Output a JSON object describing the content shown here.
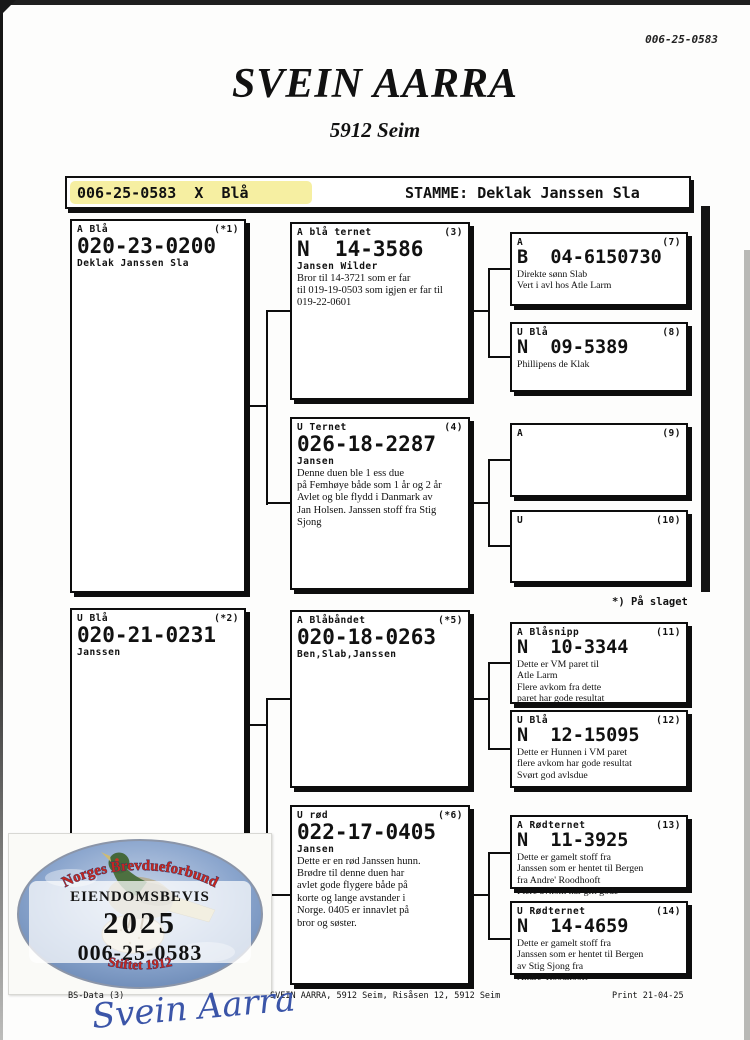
{
  "page": {
    "ref_number": "006-25-0583",
    "title": "SVEIN AARRA",
    "subtitle": "5912 Seim"
  },
  "id_bar": {
    "left_text": "006-25-0583  X  Blå",
    "stamme_text": "STAMME: Deklak Janssen Sla"
  },
  "footnote": "*) På slaget",
  "boxes": [
    {
      "color": "A Blå",
      "num": "(*1)",
      "ring": "020-23-0200",
      "strain": "Deklak Janssen Sla",
      "note": ""
    },
    {
      "color": "U Blå",
      "num": "(*2)",
      "ring": "020-21-0231",
      "strain": "Janssen",
      "note": ""
    },
    {
      "color": "A blå ternet",
      "num": "(3)",
      "ring": "N  14-3586",
      "strain": "Jansen Wilder",
      "note": "Bror til 14-3721 som er far\ntil 019-19-0503 som igjen er far til\n019-22-0601"
    },
    {
      "color": "U Ternet",
      "num": "(4)",
      "ring": "026-18-2287",
      "strain": "Jansen",
      "note": "Denne duen ble 1 ess due\npå Femhøye både som 1 år og 2 år\nAvlet og ble flydd i Danmark av\nJan Holsen. Janssen stoff fra Stig\nSjong"
    },
    {
      "color": "A Blåbåndet",
      "num": "(*5)",
      "ring": "020-18-0263",
      "strain": "Ben,Slab,Janssen",
      "note": ""
    },
    {
      "color": "U rød",
      "num": "(*6)",
      "ring": "022-17-0405",
      "strain": "Jansen",
      "note": "Dette er en rød Janssen hunn.\nBrødre til denne duen har\navlet gode flygere både på\nkorte og lange avstander i\nNorge. 0405 er innavlet på\nbror og søster."
    },
    {
      "color": "A",
      "num": "(7)",
      "ring": "B  04-6150730",
      "strain": "",
      "note": "Direkte sønn Slab\nVert i avl hos Atle Larm"
    },
    {
      "color": "U Blå",
      "num": "(8)",
      "ring": "N  09-5389",
      "strain": "",
      "note": "Phillipens de Klak"
    },
    {
      "color": "A",
      "num": "(9)",
      "ring": "",
      "strain": "",
      "note": ""
    },
    {
      "color": "U",
      "num": "(10)",
      "ring": "",
      "strain": "",
      "note": ""
    },
    {
      "color": "A Blåsnipp",
      "num": "(11)",
      "ring": "N  10-3344",
      "strain": "",
      "note": "Dette er VM paret til\nAtle Larm\nFlere avkom fra dette\nparet har gode resultat"
    },
    {
      "color": "U Blå",
      "num": "(12)",
      "ring": "N  12-15095",
      "strain": "",
      "note": "Dette er Hunnen i VM paret\nflere avkom har gode resultat\nSvørt god avlsdue"
    },
    {
      "color": "A Rødternet",
      "num": "(13)",
      "ring": "N  11-3925",
      "strain": "",
      "note": "Dette er gamelt stoff fra\nJanssen som er hentet til Bergen\nfra Andre' Roodhooft\nFlere avkom har gitt gode"
    },
    {
      "color": "U Rødternet",
      "num": "(14)",
      "ring": "N  14-4659",
      "strain": "",
      "note": "Dette er gamelt stoff fra\nJanssen som er hentet til Bergen\nav Stig Sjong fra\nAndre' Roodhooft"
    }
  ],
  "sticker": {
    "org": "Norges Brevdueforbund",
    "doc_type": "EIENDOMSBEVIS",
    "year": "2025",
    "ring": "006-25-0583",
    "founded": "Stiftet 1912"
  },
  "footer": {
    "left": "BS-Data (3)",
    "center": "SVEIN AARRA, 5912 Seim, Risåsen 12, 5912 Seim",
    "right": "Print 21-04-25"
  },
  "signature": "Svein Aarra",
  "colors": {
    "highlight_yellow": "#f6efa2",
    "sticker_red": "#c5271f",
    "signature_blue": "#3b55a8"
  }
}
